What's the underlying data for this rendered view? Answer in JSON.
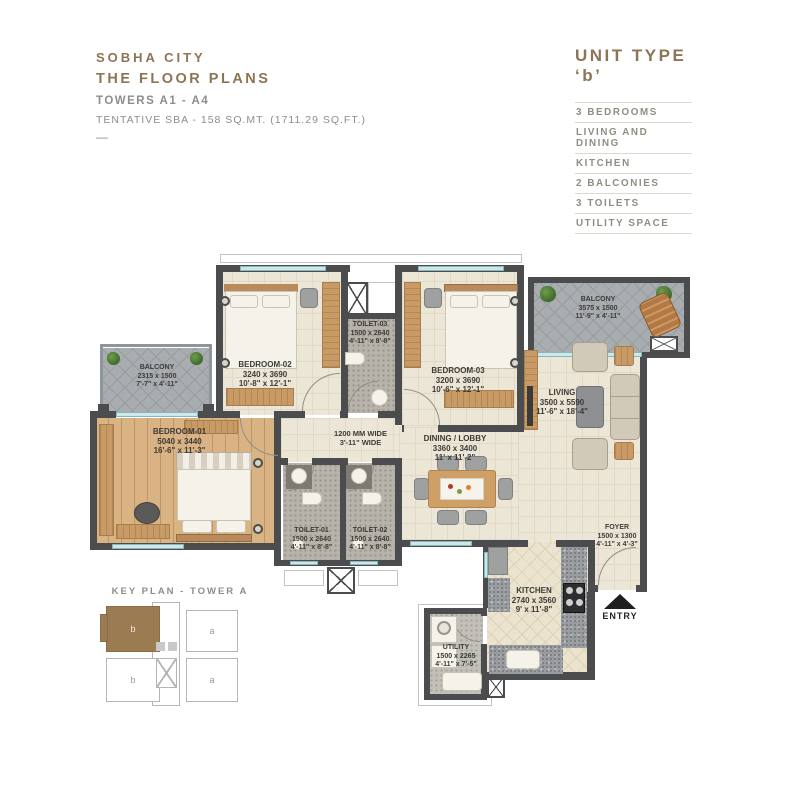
{
  "header": {
    "project": "SOBHA CITY",
    "title": "THE FLOOR PLANS",
    "towers": "TOWERS A1 - A4",
    "sba": "TENTATIVE SBA - 158 SQ.MT. (1711.29 SQ.FT.)",
    "dash": "—"
  },
  "unit_info": {
    "title": "UNIT TYPE ‘b’",
    "features": [
      "3 BEDROOMS",
      "LIVING AND DINING",
      "KITCHEN",
      "2 BALCONIES",
      "3 TOILETS",
      "UTILITY SPACE"
    ]
  },
  "rooms": {
    "bedroom1": {
      "name": "BEDROOM-01",
      "mm": "5040 x 3440",
      "ft": "16'-6\" x 11'-3\""
    },
    "bedroom2": {
      "name": "BEDROOM-02",
      "mm": "3240 x 3690",
      "ft": "10'-8\" x 12'-1\""
    },
    "bedroom3": {
      "name": "BEDROOM-03",
      "mm": "3200 x 3690",
      "ft": "10'-6\" x 12'-1\""
    },
    "toilet1": {
      "name": "TOILET-01",
      "mm": "1500 x 2640",
      "ft": "4'-11\" x 8'-8\""
    },
    "toilet2": {
      "name": "TOILET-02",
      "mm": "1500 x 2640",
      "ft": "4'-11\" x 8'-8\""
    },
    "toilet3": {
      "name": "TOILET-03",
      "mm": "1500 x 2640",
      "ft": "4'-11\" x 8'-8\""
    },
    "balcony_left": {
      "name": "BALCONY",
      "mm": "2315 x 1500",
      "ft": "7'-7\" x 4'-11\""
    },
    "balcony_right": {
      "name": "BALCONY",
      "mm": "3575 x 1500",
      "ft": "11'-9\" x 4'-11\""
    },
    "living": {
      "name": "LIVING",
      "mm": "3500 x 5590",
      "ft": "11'-6\" x 18'-4\""
    },
    "dining": {
      "name": "DINING / LOBBY",
      "mm": "3360 x 3400",
      "ft": "11' x 11'-2\""
    },
    "kitchen": {
      "name": "KITCHEN",
      "mm": "2740 x 3560",
      "ft": "9' x 11'-8\""
    },
    "utility": {
      "name": "UTILITY",
      "mm": "1500 x 2265",
      "ft": "4'-11\" x 7'-5\""
    },
    "foyer": {
      "name": "FOYER",
      "mm": "1500 x 1300",
      "ft": "4'-11\" x 4'-3\""
    },
    "corridor": {
      "l1": "1200 MM WIDE",
      "l2": "3'-11\" WIDE"
    }
  },
  "entry_label": "ENTRY",
  "key_plan": {
    "title": "KEY PLAN - TOWER A",
    "units": [
      {
        "label": "b",
        "highlighted": true
      },
      {
        "label": "a",
        "highlighted": false
      },
      {
        "label": "b",
        "highlighted": false
      },
      {
        "label": "a",
        "highlighted": false
      }
    ]
  },
  "colors": {
    "brand_brown": "#8d7454",
    "wall": "#4b4c4e",
    "floor_cream": "#ece6d6",
    "floor_wood": "#d9b384",
    "window": "#cfe7e8",
    "keyplan_highlight": "#9b7c52",
    "muted_text": "#8d8d8d"
  }
}
